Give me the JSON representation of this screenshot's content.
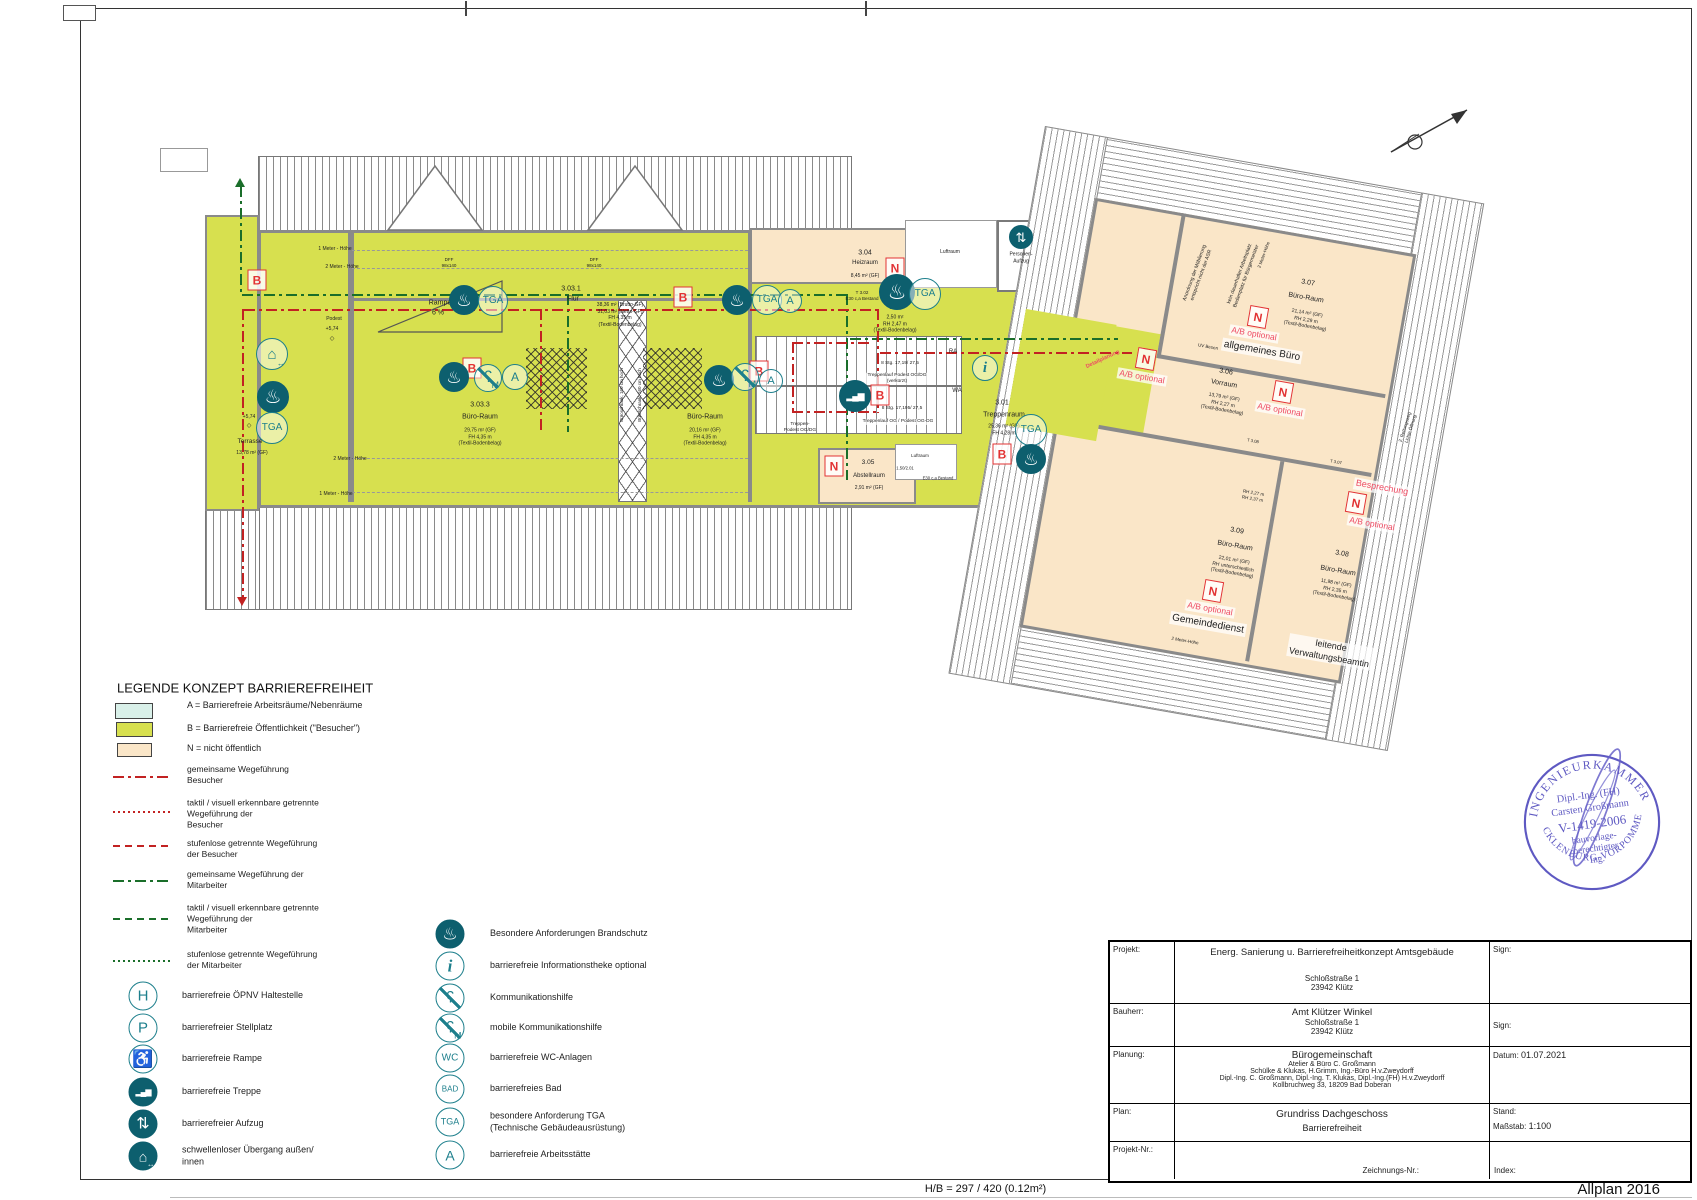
{
  "colors": {
    "green": "#d7e04f",
    "beige": "#fae6c8",
    "cyan": "#d9f0e9",
    "teal": "#1d7f8c",
    "tealdark": "#0d5f6e",
    "red": "#c22222",
    "mred": "#e23333",
    "opt": "#ee4b63",
    "pathgreen": "#1a6e2a",
    "stampblue": "#514bbd",
    "wall": "#8a8a8a"
  },
  "page": {
    "hb_label": "H/B = 297 / 420 (0.12m²)",
    "app_label": "Allplan 2016"
  },
  "icon_defs": {
    "fire": {
      "glyph": "♨",
      "cls": "ic-dark",
      "fs": 0.62,
      "name": "fire-protection"
    },
    "tga": {
      "glyph": "TGA",
      "cls": "ic-line",
      "fs": 0.34,
      "name": "tga"
    },
    "a": {
      "glyph": "A",
      "cls": "ic-line",
      "fs": 0.5,
      "name": "workplace-a"
    },
    "i": {
      "glyph": "i",
      "cls": "ic-line ic-it",
      "fs": 0.62,
      "name": "info-desk"
    },
    "h": {
      "glyph": "H",
      "cls": "ic-line",
      "fs": 0.55,
      "name": "transit-stop"
    },
    "p": {
      "glyph": "P",
      "cls": "ic-line",
      "fs": 0.55,
      "name": "parking"
    },
    "wc": {
      "glyph": "WC",
      "cls": "ic-line",
      "fs": 0.36,
      "name": "wc"
    },
    "bad": {
      "glyph": "BAD",
      "cls": "ic-line",
      "fs": 0.3,
      "name": "bath"
    },
    "ear": {
      "glyph": "ʕ",
      "cls": "ic-line slash",
      "fs": 0.6,
      "name": "hearing-aid"
    },
    "earm": {
      "glyph": "ʕ",
      "cls": "ic-line slash",
      "fs": 0.6,
      "sub": "M",
      "name": "mobile-hearing-aid"
    },
    "ramp": {
      "glyph": "♿",
      "cls": "ic-line",
      "fs": 0.62,
      "name": "ramp"
    },
    "stairs": {
      "glyph": "▂▄▆",
      "cls": "ic-dark ic-steps",
      "fs": 0.3,
      "name": "stairs"
    },
    "lift": {
      "glyph": "⇅",
      "cls": "ic-dark",
      "fs": 0.6,
      "name": "elevator"
    },
    "door": {
      "glyph": "⌂",
      "cls": "ic-dark",
      "fs": 0.5,
      "sub": "↔",
      "name": "threshold-free-door"
    },
    "door_o": {
      "glyph": "⌂",
      "cls": "ic-line",
      "fs": 0.5,
      "sub": "↔",
      "name": "threshold-free-door"
    }
  },
  "legend": {
    "title": "LEGENDE KONZEPT BARRIEREFREIHEIT",
    "areas": [
      {
        "x": 115,
        "y": 703,
        "w": 36,
        "h": 14,
        "color": "#d9f0e9",
        "lx": 187,
        "ly": 706,
        "label": "A = Barrierefreie Arbeitsräume/Nebenräume"
      },
      {
        "x": 116,
        "y": 722,
        "w": 35,
        "h": 13,
        "color": "#d7e04f",
        "lx": 187,
        "ly": 729,
        "label": "B = Barrierefreie Öffentlichkeit (\"Besucher\")"
      },
      {
        "x": 117,
        "y": 743,
        "w": 33,
        "h": 12,
        "color": "#fae6c8",
        "lx": 187,
        "ly": 749,
        "label": "N = nicht öffentlich"
      }
    ],
    "lines": [
      {
        "y": 776,
        "style": "dd",
        "color": "red",
        "ly": 775,
        "label": "gemeinsame Wegeführung\nBesucher"
      },
      {
        "y": 811,
        "style": "do",
        "color": "red",
        "ly": 814,
        "label": "taktil / visuell erkennbare getrennte\nWegeführung der\nBesucher"
      },
      {
        "y": 845,
        "style": "da",
        "color": "red",
        "ly": 849,
        "label": "stufenlose getrennte Wegeführung\nder Besucher"
      },
      {
        "y": 880,
        "style": "dd",
        "color": "grn",
        "ly": 880,
        "label": "gemeinsame Wegeführung der\nMitarbeiter"
      },
      {
        "y": 918,
        "style": "da",
        "color": "grn",
        "ly": 919,
        "label": "taktil / visuell erkennbare getrennte\nWegeführung der\nMitarbeiter"
      },
      {
        "y": 960,
        "style": "do",
        "color": "grn",
        "ly": 960,
        "label": "stufenlose getrennte Wegeführung\nder Mitarbeiter"
      }
    ],
    "icons_left": [
      {
        "k": "h",
        "y": 996,
        "label": "barrierefreie ÖPNV Haltestelle"
      },
      {
        "k": "p",
        "y": 1028,
        "label": "barrierefreier Stellplatz"
      },
      {
        "k": "ramp",
        "y": 1059,
        "label": "barrierefreie Rampe"
      },
      {
        "k": "stairs",
        "y": 1092,
        "label": "barrierefreie Treppe"
      },
      {
        "k": "lift",
        "y": 1124,
        "label": "barrierefreier Aufzug"
      },
      {
        "k": "door",
        "y": 1156,
        "label": "schwellenloser Übergang außen/\ninnen"
      }
    ],
    "icons_right": [
      {
        "k": "fire",
        "y": 934,
        "label": "Besondere Anforderungen Brandschutz"
      },
      {
        "k": "i",
        "y": 966,
        "label": "barrierefreie Informationstheke optional"
      },
      {
        "k": "ear",
        "y": 998,
        "label": "Kommunikationshilfe"
      },
      {
        "k": "earm",
        "y": 1028,
        "label": "mobile Kommunikationshilfe"
      },
      {
        "k": "wc",
        "y": 1058,
        "label": "barrierefreie WC-Anlagen"
      },
      {
        "k": "bad",
        "y": 1089,
        "label": "barrierefreies Bad"
      },
      {
        "k": "tga",
        "y": 1122,
        "label": "besondere Anforderung TGA\n(Technische Gebäudeausrüstung)"
      },
      {
        "k": "a",
        "y": 1155,
        "label": "barrierefreie Arbeitsstätte"
      }
    ]
  },
  "plan": {
    "texts": [
      {
        "t": "3.03.1",
        "x": 571,
        "y": 289,
        "fs": 7
      },
      {
        "t": "Flur",
        "x": 573,
        "y": 299,
        "fs": 7
      },
      {
        "t": "38,36 m² (Brutto-GF)\n31,03 m² (Netto-GF)\nFH 4,35 m\n(Textil-Bodenbelag)",
        "x": 620,
        "y": 315,
        "fs": 5
      },
      {
        "t": "3.03.3",
        "x": 480,
        "y": 405,
        "fs": 7
      },
      {
        "t": "Büro-Raum",
        "x": 480,
        "y": 417,
        "fs": 7
      },
      {
        "t": "29,75 m² (GF)\nFH 4,35 m\n(Textil-Bodenbelag)",
        "x": 480,
        "y": 437,
        "fs": 5
      },
      {
        "t": "Büro-Raum",
        "x": 705,
        "y": 417,
        "fs": 7
      },
      {
        "t": "20,16 m² (GF)\nFH 4,35 m\n(Textil-Bodenbelag)",
        "x": 705,
        "y": 437,
        "fs": 5
      },
      {
        "t": "Rampe",
        "x": 440,
        "y": 303,
        "fs": 7
      },
      {
        "t": "6 %",
        "x": 438,
        "y": 313,
        "fs": 7
      },
      {
        "t": "DFF\n98x140",
        "x": 449,
        "y": 263,
        "fs": 4.5
      },
      {
        "t": "DFF\n98x140",
        "x": 594,
        "y": 263,
        "fs": 4.5
      },
      {
        "t": "1 Meter - Höhe",
        "x": 335,
        "y": 249,
        "fs": 5
      },
      {
        "t": "2 Meter - Höhe",
        "x": 342,
        "y": 267,
        "fs": 5
      },
      {
        "t": "2 Meter - Höhe",
        "x": 350,
        "y": 459,
        "fs": 5
      },
      {
        "t": "1 Meter - Höhe",
        "x": 336,
        "y": 494,
        "fs": 5
      },
      {
        "t": "Terrasse",
        "x": 250,
        "y": 442,
        "fs": 6.5
      },
      {
        "t": "13,78 m² (GF)",
        "x": 252,
        "y": 453,
        "fs": 5
      },
      {
        "t": "+5,74",
        "x": 249,
        "y": 417,
        "fs": 5
      },
      {
        "t": "◇",
        "x": 249,
        "y": 427,
        "fs": 6
      },
      {
        "t": "Podest",
        "x": 334,
        "y": 319,
        "fs": 5
      },
      {
        "t": "+5,74",
        "x": 332,
        "y": 329,
        "fs": 5
      },
      {
        "t": "◇",
        "x": 332,
        "y": 340,
        "fs": 6
      },
      {
        "t": "Büroschrank, 160 cm hoch",
        "x": 622,
        "y": 395,
        "fs": 4.5,
        "r": -90
      },
      {
        "t": "Büroschrank, 160 cm hoch",
        "x": 640,
        "y": 395,
        "fs": 4.5,
        "r": -90
      },
      {
        "t": "3.04",
        "x": 865,
        "y": 253,
        "fs": 7
      },
      {
        "t": "Heizraum",
        "x": 865,
        "y": 264,
        "fs": 6
      },
      {
        "t": "8,45 m² (GF)",
        "x": 865,
        "y": 276,
        "fs": 5
      },
      {
        "t": "T 3.02\nE30 c,a Bestand",
        "x": 862,
        "y": 296,
        "fs": 4.5
      },
      {
        "t": "Flur",
        "x": 895,
        "y": 308,
        "fs": 6.5
      },
      {
        "t": "2,50 m²\nRH 2,47 m\n(Textil-Bodenbelag)",
        "x": 895,
        "y": 324,
        "fs": 5
      },
      {
        "t": "Luftraum",
        "x": 950,
        "y": 252,
        "fs": 5
      },
      {
        "t": "Personen-\nAufzug",
        "x": 1021,
        "y": 258,
        "fs": 5
      },
      {
        "t": "RA",
        "x": 953,
        "y": 353,
        "fs": 6
      },
      {
        "t": "WA",
        "x": 957,
        "y": 392,
        "fs": 6
      },
      {
        "t": "8 Stg. 17,19/ 27,5",
        "x": 900,
        "y": 364,
        "fs": 4.8
      },
      {
        "t": "Treppenlauf Podest OG/DG\n(verkürzt)",
        "x": 897,
        "y": 379,
        "fs": 4.8,
        "cls": "halo"
      },
      {
        "t": "8 Stg. 17,195/ 27,5",
        "x": 902,
        "y": 409,
        "fs": 4.8
      },
      {
        "t": "Treppenlauf OG / Podest OG-DG",
        "x": 898,
        "y": 422,
        "fs": 4.8,
        "cls": "halo"
      },
      {
        "t": "Treppen-\nPodest OG/DG",
        "x": 800,
        "y": 428,
        "fs": 4.8
      },
      {
        "t": "3.01",
        "x": 1002,
        "y": 403,
        "fs": 7
      },
      {
        "t": "Treppenraum",
        "x": 1004,
        "y": 415,
        "fs": 7
      },
      {
        "t": "25,36 m² (GF)\nFH 4,28 m",
        "x": 1004,
        "y": 430,
        "fs": 5
      },
      {
        "t": "3.05",
        "x": 868,
        "y": 463,
        "fs": 6.5
      },
      {
        "t": "Abstellraum",
        "x": 869,
        "y": 477,
        "fs": 6
      },
      {
        "t": "2,91 m² (GF)",
        "x": 869,
        "y": 488,
        "fs": 5
      },
      {
        "t": "1.50/2.01",
        "x": 905,
        "y": 468,
        "fs": 4.2
      },
      {
        "t": "E30 c,a Bestand",
        "x": 938,
        "y": 478,
        "fs": 4.2
      },
      {
        "t": "Luftraum",
        "x": 920,
        "y": 456,
        "fs": 4.5
      },
      {
        "t": "3.07",
        "x": 1308,
        "y": 283,
        "fs": 7,
        "r": 10
      },
      {
        "t": "Büro-Raum",
        "x": 1306,
        "y": 298,
        "fs": 7,
        "r": 10
      },
      {
        "t": "21,14 m² (GF)\nRH 2,29 m\n(Textil-Bodenbelag)",
        "x": 1306,
        "y": 320,
        "fs": 5,
        "r": 10
      },
      {
        "t": "allgemeines Büro",
        "x": 1262,
        "y": 351,
        "fs": 10,
        "r": 10,
        "cls": "halo"
      },
      {
        "t": "3.06",
        "x": 1226,
        "y": 372,
        "fs": 7,
        "r": 10
      },
      {
        "t": "Vorraum",
        "x": 1224,
        "y": 384,
        "fs": 7,
        "r": 10
      },
      {
        "t": "13,79 m² (GF)\nRH 2,27 m\n(Textil-Bodenbelag)",
        "x": 1223,
        "y": 404,
        "fs": 5,
        "r": 10
      },
      {
        "t": "3.09",
        "x": 1237,
        "y": 531,
        "fs": 7,
        "r": 10
      },
      {
        "t": "Büro-Raum",
        "x": 1235,
        "y": 546,
        "fs": 7,
        "r": 10
      },
      {
        "t": "22,01 m² (GF)\nRH unterschiedlich\n(Textil-Bodenbelag)",
        "x": 1233,
        "y": 567,
        "fs": 5,
        "r": 10
      },
      {
        "t": "Gemeindedienst",
        "x": 1208,
        "y": 624,
        "fs": 10,
        "r": 10,
        "cls": "halo"
      },
      {
        "t": "2 Meter-Höhe",
        "x": 1185,
        "y": 641,
        "fs": 4.5,
        "r": 10
      },
      {
        "t": "3.08",
        "x": 1342,
        "y": 554,
        "fs": 7,
        "r": 10
      },
      {
        "t": "Büro-Raum",
        "x": 1338,
        "y": 571,
        "fs": 7,
        "r": 10
      },
      {
        "t": "11,98 m² (GF)\nRH 2,35 m\n(Textil-Bodenbelag)",
        "x": 1335,
        "y": 590,
        "fs": 5,
        "r": 10
      },
      {
        "t": "leitende\nVerwaltungsbeamtin",
        "x": 1330,
        "y": 652,
        "fs": 9,
        "r": 10,
        "cls": "halo"
      },
      {
        "t": "Besprechung",
        "x": 1382,
        "y": 488,
        "fs": 9,
        "r": 10,
        "cls": "opt"
      },
      {
        "t": "A/B optional",
        "x": 1254,
        "y": 334,
        "fs": 8.5,
        "r": 10,
        "cls": "opt"
      },
      {
        "t": "A/B optional",
        "x": 1142,
        "y": 377,
        "fs": 8.5,
        "r": 10,
        "cls": "opt"
      },
      {
        "t": "A/B optional",
        "x": 1280,
        "y": 410,
        "fs": 8.5,
        "r": 10,
        "cls": "opt"
      },
      {
        "t": "A/B optional",
        "x": 1372,
        "y": 524,
        "fs": 8.5,
        "r": 10,
        "cls": "opt"
      },
      {
        "t": "A/B optional",
        "x": 1210,
        "y": 609,
        "fs": 8.5,
        "r": 10,
        "cls": "opt"
      },
      {
        "t": "Detailplanung",
        "x": 1103,
        "y": 360,
        "fs": 5.5,
        "r": -25,
        "cls": "redtx"
      },
      {
        "t": "Anordnung der Möblierung\nentspricht nicht der ASR",
        "x": 1198,
        "y": 274,
        "fs": 5,
        "r": -70
      },
      {
        "t": "kein dauerhafter Arbeitsplatz\nBedienplatz für Bürgermeister",
        "x": 1243,
        "y": 275,
        "fs": 5,
        "r": -70
      },
      {
        "t": "2 Meter-Höhe",
        "x": 1264,
        "y": 255,
        "fs": 4.5,
        "r": -70
      },
      {
        "t": "2. Rettungsweg\nLichte Öffnung",
        "x": 1408,
        "y": 428,
        "fs": 4.5,
        "r": -72
      },
      {
        "t": "UV Besen",
        "x": 1208,
        "y": 347,
        "fs": 4.5,
        "r": 10
      },
      {
        "t": "RH 2,27 m\nRH 2,37 m",
        "x": 1253,
        "y": 496,
        "fs": 4.5,
        "r": 10
      },
      {
        "t": "T 3.08",
        "x": 1253,
        "y": 441,
        "fs": 4.2,
        "r": 10
      },
      {
        "t": "T 3.07",
        "x": 1336,
        "y": 462,
        "fs": 4.2,
        "r": 10
      }
    ],
    "markers": [
      {
        "t": "B",
        "x": 257,
        "y": 280
      },
      {
        "t": "B",
        "x": 472,
        "y": 368
      },
      {
        "t": "B",
        "x": 759,
        "y": 371
      },
      {
        "t": "B",
        "x": 683,
        "y": 297
      },
      {
        "t": "B",
        "x": 880,
        "y": 395
      },
      {
        "t": "B",
        "x": 1002,
        "y": 454
      },
      {
        "t": "N",
        "x": 895,
        "y": 268
      },
      {
        "t": "N",
        "x": 834,
        "y": 466
      },
      {
        "t": "N",
        "x": 1258,
        "y": 317,
        "r": 10
      },
      {
        "t": "N",
        "x": 1146,
        "y": 359,
        "r": 10
      },
      {
        "t": "N",
        "x": 1283,
        "y": 392,
        "r": 10
      },
      {
        "t": "N",
        "x": 1356,
        "y": 503,
        "r": 10
      },
      {
        "t": "N",
        "x": 1213,
        "y": 591,
        "r": 10
      }
    ],
    "icons": [
      {
        "k": "fire",
        "x": 464,
        "y": 300,
        "s": 28
      },
      {
        "k": "tga",
        "x": 493,
        "y": 301,
        "s": 28
      },
      {
        "k": "fire",
        "x": 737,
        "y": 300,
        "s": 28
      },
      {
        "k": "tga",
        "x": 767,
        "y": 300,
        "s": 28
      },
      {
        "k": "a",
        "x": 790,
        "y": 301,
        "s": 22
      },
      {
        "k": "fire",
        "x": 897,
        "y": 292,
        "s": 34
      },
      {
        "k": "tga",
        "x": 925,
        "y": 294,
        "s": 30
      },
      {
        "k": "fire",
        "x": 454,
        "y": 377,
        "s": 28
      },
      {
        "k": "earm",
        "x": 488,
        "y": 378,
        "s": 26
      },
      {
        "k": "a",
        "x": 515,
        "y": 377,
        "s": 24
      },
      {
        "k": "fire",
        "x": 719,
        "y": 380,
        "s": 28
      },
      {
        "k": "earm",
        "x": 745,
        "y": 377,
        "s": 26
      },
      {
        "k": "a",
        "x": 771,
        "y": 381,
        "s": 22
      },
      {
        "k": "door_o",
        "x": 272,
        "y": 354,
        "s": 30
      },
      {
        "k": "fire",
        "x": 273,
        "y": 397,
        "s": 30
      },
      {
        "k": "tga",
        "x": 272,
        "y": 428,
        "s": 30
      },
      {
        "k": "stairs",
        "x": 855,
        "y": 396,
        "s": 30
      },
      {
        "k": "i",
        "x": 985,
        "y": 368,
        "s": 24
      },
      {
        "k": "tga",
        "x": 1031,
        "y": 430,
        "s": 30
      },
      {
        "k": "fire",
        "x": 1031,
        "y": 459,
        "s": 28
      },
      {
        "k": "lift",
        "x": 1021,
        "y": 237,
        "s": 22
      }
    ]
  },
  "titleblock": {
    "projekt": {
      "label": "Projekt:",
      "line1": "Energ. Sanierung u. Barrierefreiheitkonzept Amtsgebäude",
      "line2": "Schloßstraße 1",
      "line3": "23942 Klütz",
      "sign": "Sign:"
    },
    "bauherr": {
      "label": "Bauherr:",
      "line1": "Amt Klützer Winkel",
      "line2": "Schloßstraße 1",
      "line3": "23942 Klütz",
      "sign": "Sign:"
    },
    "planung": {
      "label": "Planung:",
      "line1": "Bürogemeinschaft",
      "line2": "Atelier & Büro C. Großmann",
      "line3": "Schülke & Klukas, H.Grimm, Ing.-Büro H.v.Zweydorff",
      "line4": "Dipl.-Ing. C. Großmann, Dipl.-Ing. T. Klukas, Dipl.-Ing.(FH) H.v.Zweydorff",
      "line5": "Kollbruchweg 33, 18209 Bad Doberan",
      "datum_label": "Datum:",
      "datum": "01.07.2021"
    },
    "plan": {
      "label": "Plan:",
      "line1": "Grundriss Dachgeschoss",
      "line2": "Barrierefreiheit",
      "stand_label": "Stand:",
      "massstab_label": "Maßstab:",
      "massstab": "1:100"
    },
    "nr": {
      "label": "Projekt-Nr.:",
      "zeichnung_label": "Zeichnungs-Nr.:",
      "index_label": "Index:"
    }
  },
  "stamp": {
    "arc_top": "INGENIEURKAMMER",
    "arc_bottom": "MECKLENBURG-VORPOMMERN",
    "line1": "Dipl.-Ing. (FH)",
    "line2": "Carsten Großmann",
    "line3": "V-1419-2006",
    "line4": "bauvorlage-",
    "line5": "berechtigter",
    "line6": "Ing."
  }
}
